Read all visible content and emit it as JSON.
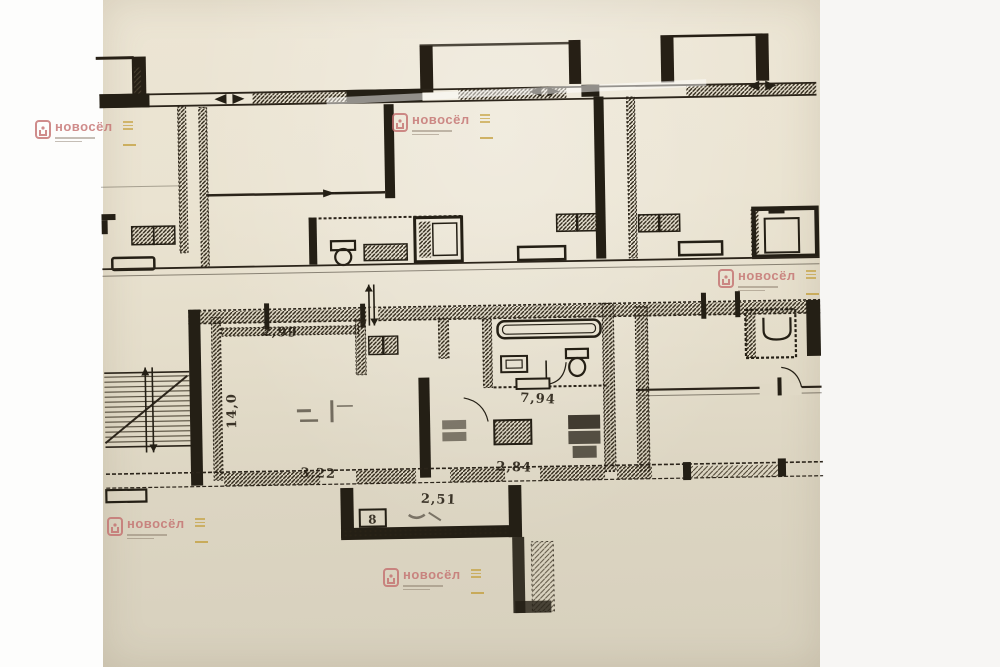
{
  "document": {
    "kind": "scanned-floor-plan-photo",
    "paper_color": "#e7e0cd",
    "ink_color": "#2b241a"
  },
  "watermark": {
    "brand": "новосёл",
    "brand_color": "#c4706f",
    "accent_color": "#c09a2c"
  },
  "plan": {
    "dimensions": [
      {
        "id": "room-top-width",
        "text": "2,99"
      },
      {
        "id": "living-room-area",
        "text": "14,0"
      },
      {
        "id": "room-bottom-width",
        "text": "3,22"
      },
      {
        "id": "kitchen-area",
        "text": "7,94"
      },
      {
        "id": "kitchen-bottom-width",
        "text": "2,84"
      },
      {
        "id": "porch-width",
        "text": "2,51"
      },
      {
        "id": "porch-room-number",
        "text": "8"
      }
    ]
  }
}
